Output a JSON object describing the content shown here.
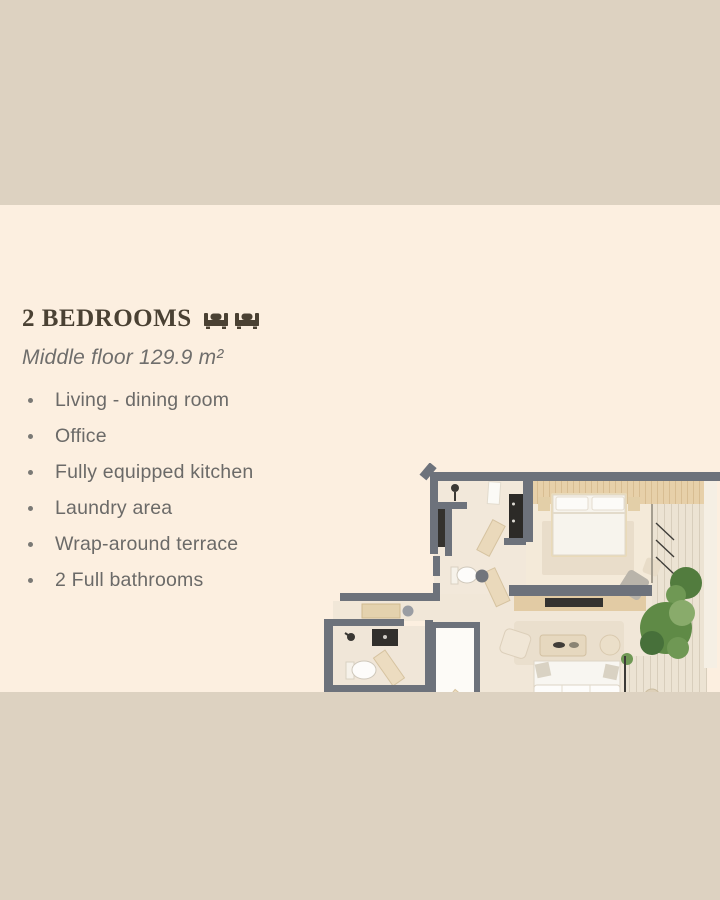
{
  "slide": {
    "title": "2 BEDROOMS",
    "title_icons": [
      "bed-icon",
      "bed-icon"
    ],
    "subtitle": "Middle floor 129.9 m²",
    "features": [
      "Living - dining room",
      "Office",
      "Fully equipped kitchen",
      "Laundry area",
      "Wrap-around terrace",
      "2 Full bathrooms"
    ]
  },
  "floor_plan": {
    "description": "3D top-down floor plan of a 2-bedroom apartment with wrap-around terrace"
  },
  "colors": {
    "band": "#ddd2c1",
    "panel": "#fcefe0",
    "title_text": "#4a4133",
    "body_text": "#6b6a68",
    "wall": "#6d727b",
    "floor": "#f2e8da",
    "wood": "#e7d0a9",
    "deck": "#e9e0d0",
    "plant_green": "#5f8a46",
    "dark_fixture": "#2c2a27"
  }
}
